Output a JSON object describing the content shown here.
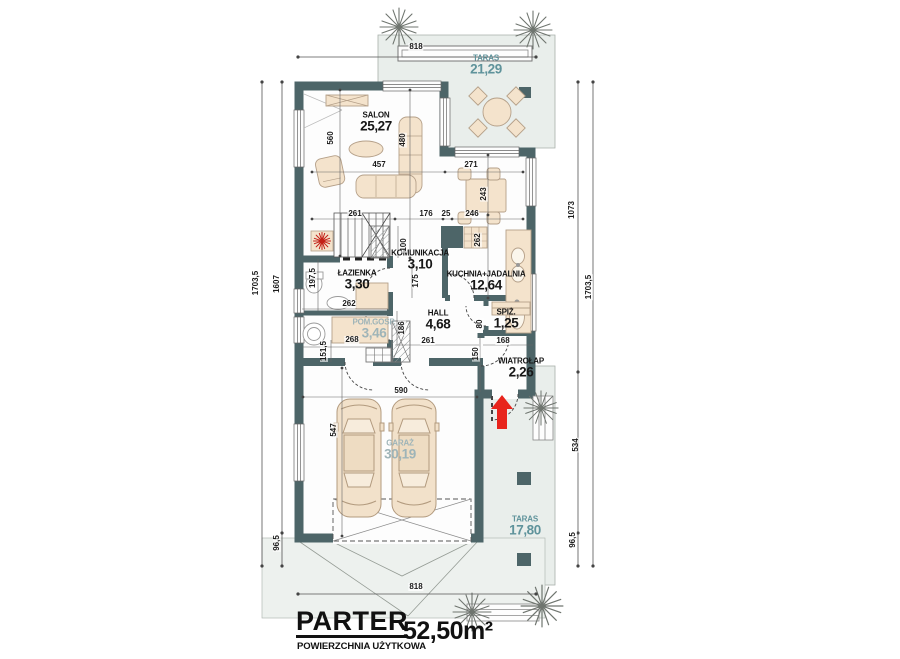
{
  "plan": {
    "floor_title": "PARTER",
    "area_caption": "POWIERZCHNIA UŻYTKOWA",
    "total_area": "52,50m²"
  },
  "rooms": [
    {
      "id": "taras-gorny",
      "name": "TARAS",
      "area": "21,29",
      "style": "teal",
      "x": 486,
      "y": 66
    },
    {
      "id": "salon",
      "name": "SALON",
      "area": "25,27",
      "style": "dark",
      "x": 376,
      "y": 123
    },
    {
      "id": "komunikacja",
      "name": "KOMUNIKACJA",
      "area": "3,10",
      "style": "dark",
      "x": 420,
      "y": 261
    },
    {
      "id": "lazienka",
      "name": "ŁAZIENKA",
      "area": "3,30",
      "style": "dark",
      "x": 357,
      "y": 281
    },
    {
      "id": "kuchnia-jadalnia",
      "name": "KUCHNIA+JADALNIA",
      "area": "12,64",
      "style": "dark",
      "x": 486,
      "y": 282
    },
    {
      "id": "pom-gosp",
      "name": "POM.GOSP.",
      "area": "3,46",
      "style": "teal-light",
      "x": 374,
      "y": 330
    },
    {
      "id": "hall",
      "name": "HALL",
      "area": "4,68",
      "style": "dark",
      "x": 438,
      "y": 321
    },
    {
      "id": "spiz",
      "name": "SPIŻ.",
      "area": "1,25",
      "style": "dark",
      "x": 506,
      "y": 320
    },
    {
      "id": "wiatrolap",
      "name": "WIATROŁAP",
      "area": "2,26",
      "style": "dark",
      "x": 521,
      "y": 369
    },
    {
      "id": "garaz",
      "name": "GARAŻ",
      "area": "30,19",
      "style": "teal-light",
      "x": 400,
      "y": 451
    },
    {
      "id": "taras-dolny",
      "name": "TARAS",
      "area": "17,80",
      "style": "teal",
      "x": 525,
      "y": 527
    }
  ],
  "dimensions": [
    {
      "text": "818",
      "x": 416,
      "y": 47,
      "v": false
    },
    {
      "text": "560",
      "x": 331,
      "y": 138,
      "v": true
    },
    {
      "text": "480",
      "x": 403,
      "y": 140,
      "v": true
    },
    {
      "text": "457",
      "x": 379,
      "y": 165,
      "v": false
    },
    {
      "text": "271",
      "x": 471,
      "y": 165,
      "v": false
    },
    {
      "text": "243",
      "x": 484,
      "y": 194,
      "v": true
    },
    {
      "text": "261",
      "x": 355,
      "y": 214,
      "v": false
    },
    {
      "text": "176",
      "x": 426,
      "y": 214,
      "v": false
    },
    {
      "text": "25",
      "x": 446,
      "y": 214,
      "v": false
    },
    {
      "text": "246",
      "x": 472,
      "y": 214,
      "v": false
    },
    {
      "text": "100",
      "x": 404,
      "y": 245,
      "v": true
    },
    {
      "text": "262",
      "x": 478,
      "y": 240,
      "v": true
    },
    {
      "text": "197,5",
      "x": 313,
      "y": 278,
      "v": true
    },
    {
      "text": "175",
      "x": 416,
      "y": 281,
      "v": true
    },
    {
      "text": "262",
      "x": 349,
      "y": 304,
      "v": false
    },
    {
      "text": "268",
      "x": 352,
      "y": 340,
      "v": false
    },
    {
      "text": "151,5",
      "x": 324,
      "y": 351,
      "v": true
    },
    {
      "text": "186",
      "x": 402,
      "y": 328,
      "v": true
    },
    {
      "text": "261",
      "x": 428,
      "y": 341,
      "v": false
    },
    {
      "text": "80",
      "x": 480,
      "y": 324,
      "v": true
    },
    {
      "text": "168",
      "x": 503,
      "y": 341,
      "v": false
    },
    {
      "text": "150",
      "x": 476,
      "y": 354,
      "v": true
    },
    {
      "text": "590",
      "x": 401,
      "y": 391,
      "v": false
    },
    {
      "text": "547",
      "x": 334,
      "y": 430,
      "v": true
    },
    {
      "text": "818",
      "x": 416,
      "y": 587,
      "v": false
    },
    {
      "text": "1703,5",
      "x": 256,
      "y": 283,
      "v": true
    },
    {
      "text": "1607",
      "x": 277,
      "y": 284,
      "v": true
    },
    {
      "text": "96,5",
      "x": 277,
      "y": 543,
      "v": true
    },
    {
      "text": "1073",
      "x": 572,
      "y": 210,
      "v": true
    },
    {
      "text": "1703,5",
      "x": 589,
      "y": 287,
      "v": true
    },
    {
      "text": "534",
      "x": 576,
      "y": 445,
      "v": true
    },
    {
      "text": "96,5",
      "x": 573,
      "y": 540,
      "v": true
    }
  ],
  "colors": {
    "wall": "#4d6568",
    "terrace_fill": "#e9eeeb",
    "ground_fill": "#edf1ee",
    "furniture": "#f4e3cc",
    "accent_teal": "#5f939b",
    "accent_teal_light": "#9eb4b8",
    "entrance_arrow_red": "#e8241c"
  }
}
